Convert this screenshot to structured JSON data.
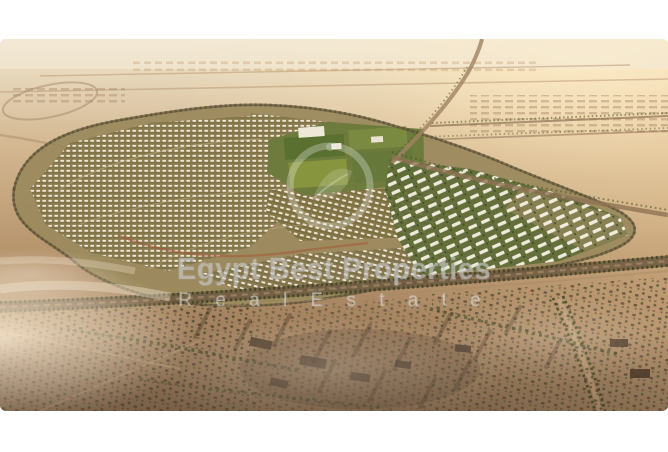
{
  "image": {
    "description": "Aerial sunset render of a large master-planned residential compound surrounded by desert, roads and existing neighborhoods"
  },
  "watermark": {
    "brand_line1": "Egypt Best Properties",
    "brand_line2": "R e a l   E s t a t e",
    "logo": "circular-leaf-emblem"
  },
  "palette": {
    "frame_bg": "#ffffff",
    "sky_haze": "#f0e5cf",
    "desert_light": "#d8bd9b",
    "desert_mid": "#b3916e",
    "desert_dark": "#8a6f55",
    "site_ground": "#96845a",
    "greenery_dark": "#5a7030",
    "greenery_light": "#87953f",
    "building_white": "#f3eedf",
    "road_dark": "#6d5941",
    "road_red": "#a85438",
    "wm_text": "rgba(200,200,200,0.55)",
    "wm_text_light": "rgba(228,228,228,0.5)"
  }
}
